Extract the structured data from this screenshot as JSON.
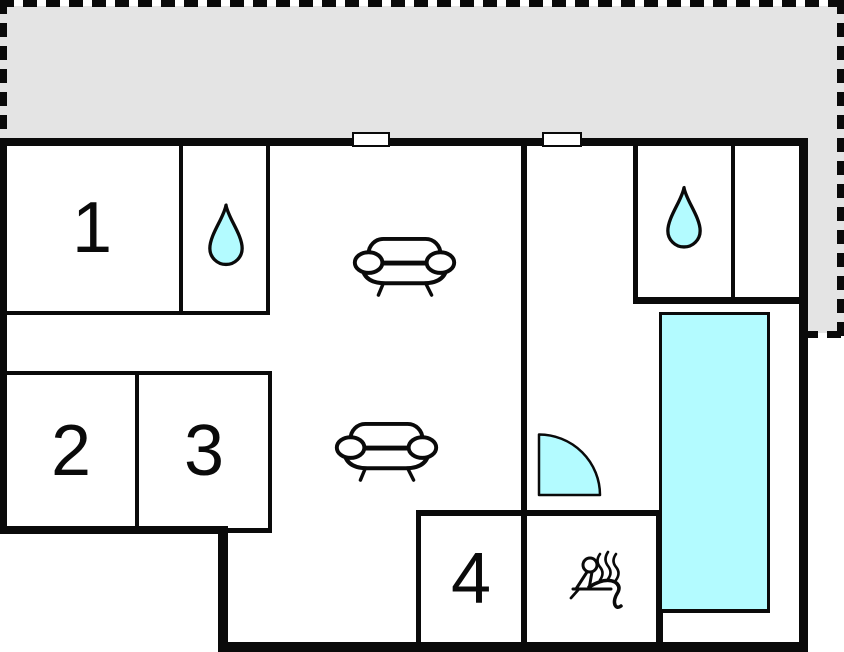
{
  "colors": {
    "wall": "#0a0a0a",
    "water": "#b3fbff",
    "terrace": "#e4e4e4",
    "floor": "#ffffff"
  },
  "rooms": [
    {
      "id": "room-1",
      "label": "1"
    },
    {
      "id": "room-2",
      "label": "2"
    },
    {
      "id": "room-3",
      "label": "3"
    },
    {
      "id": "room-4",
      "label": "4"
    }
  ],
  "icons": {
    "bathroom": "water-drop",
    "living_area": "sofa",
    "sauna": "sauna-person-with-steam",
    "shower": "quarter-circle-shower",
    "pool": "swimming-pool-rectangle",
    "window": "window-opening",
    "terrace": "dashed-outline-area"
  }
}
